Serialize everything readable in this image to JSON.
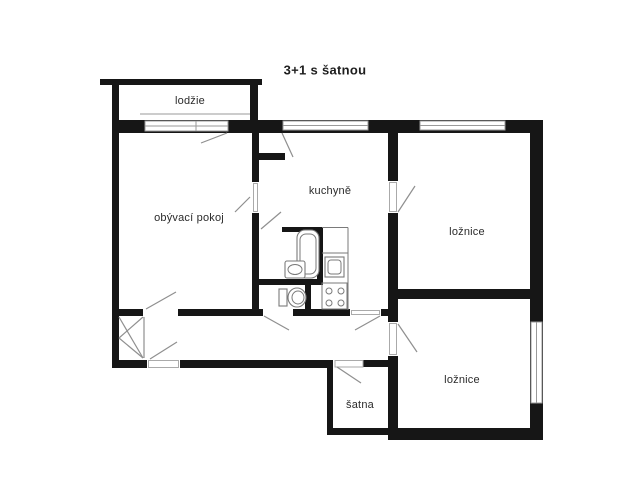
{
  "title": "3+1 s šatnou",
  "floor_plan": {
    "rooms": [
      {
        "name": "loggia",
        "label": "lodžie"
      },
      {
        "name": "living-room",
        "label": "obývací pokoj"
      },
      {
        "name": "kitchen",
        "label": "kuchyně"
      },
      {
        "name": "bedroom-1",
        "label": "ložnice"
      },
      {
        "name": "bedroom-2",
        "label": "ložnice"
      },
      {
        "name": "closet",
        "label": "šatna"
      }
    ],
    "fixtures": [
      "bathtub",
      "bathroom-sink",
      "toilet",
      "kitchen-sink",
      "stove",
      "built-in-wardrobe"
    ],
    "colors": {
      "wall": "#161616",
      "door_swing_line": "#8f8f8f",
      "fixture_line": "#7a7a7a",
      "background": "#ffffff",
      "label_text": "#2b2b2b"
    }
  }
}
